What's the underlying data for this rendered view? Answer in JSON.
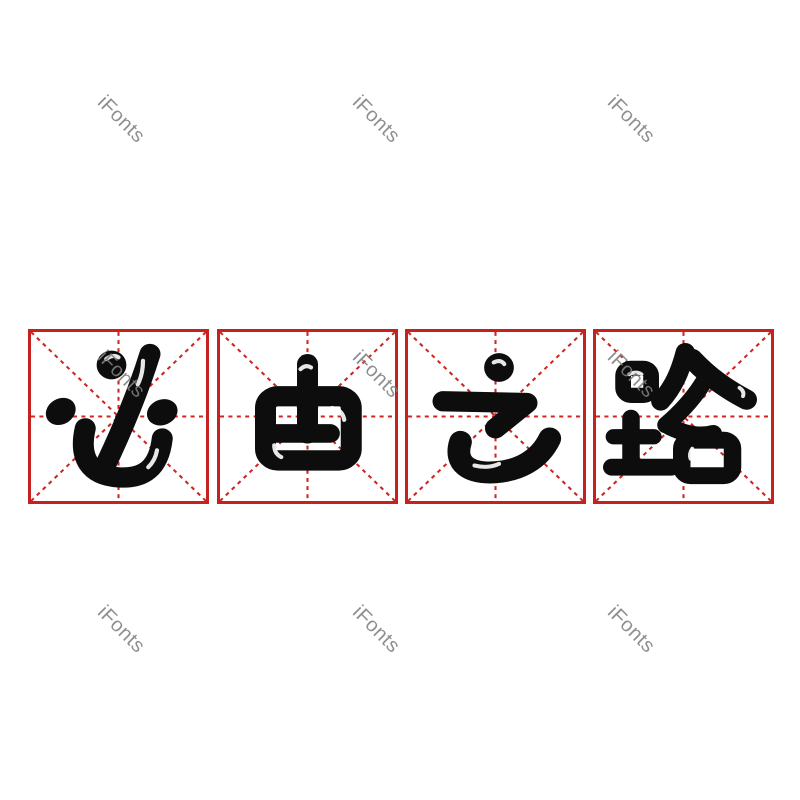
{
  "phrase": "必由之路",
  "characters": [
    {
      "char": "必"
    },
    {
      "char": "由"
    },
    {
      "char": "之"
    },
    {
      "char": "路"
    }
  ],
  "watermark": {
    "text": "iFonts"
  },
  "colors": {
    "grid_border_red": "#c4211f",
    "grid_line_red": "#d02622",
    "ink_black": "#0d0d0d",
    "watermark_gray": "#808080",
    "background": "#ffffff"
  }
}
